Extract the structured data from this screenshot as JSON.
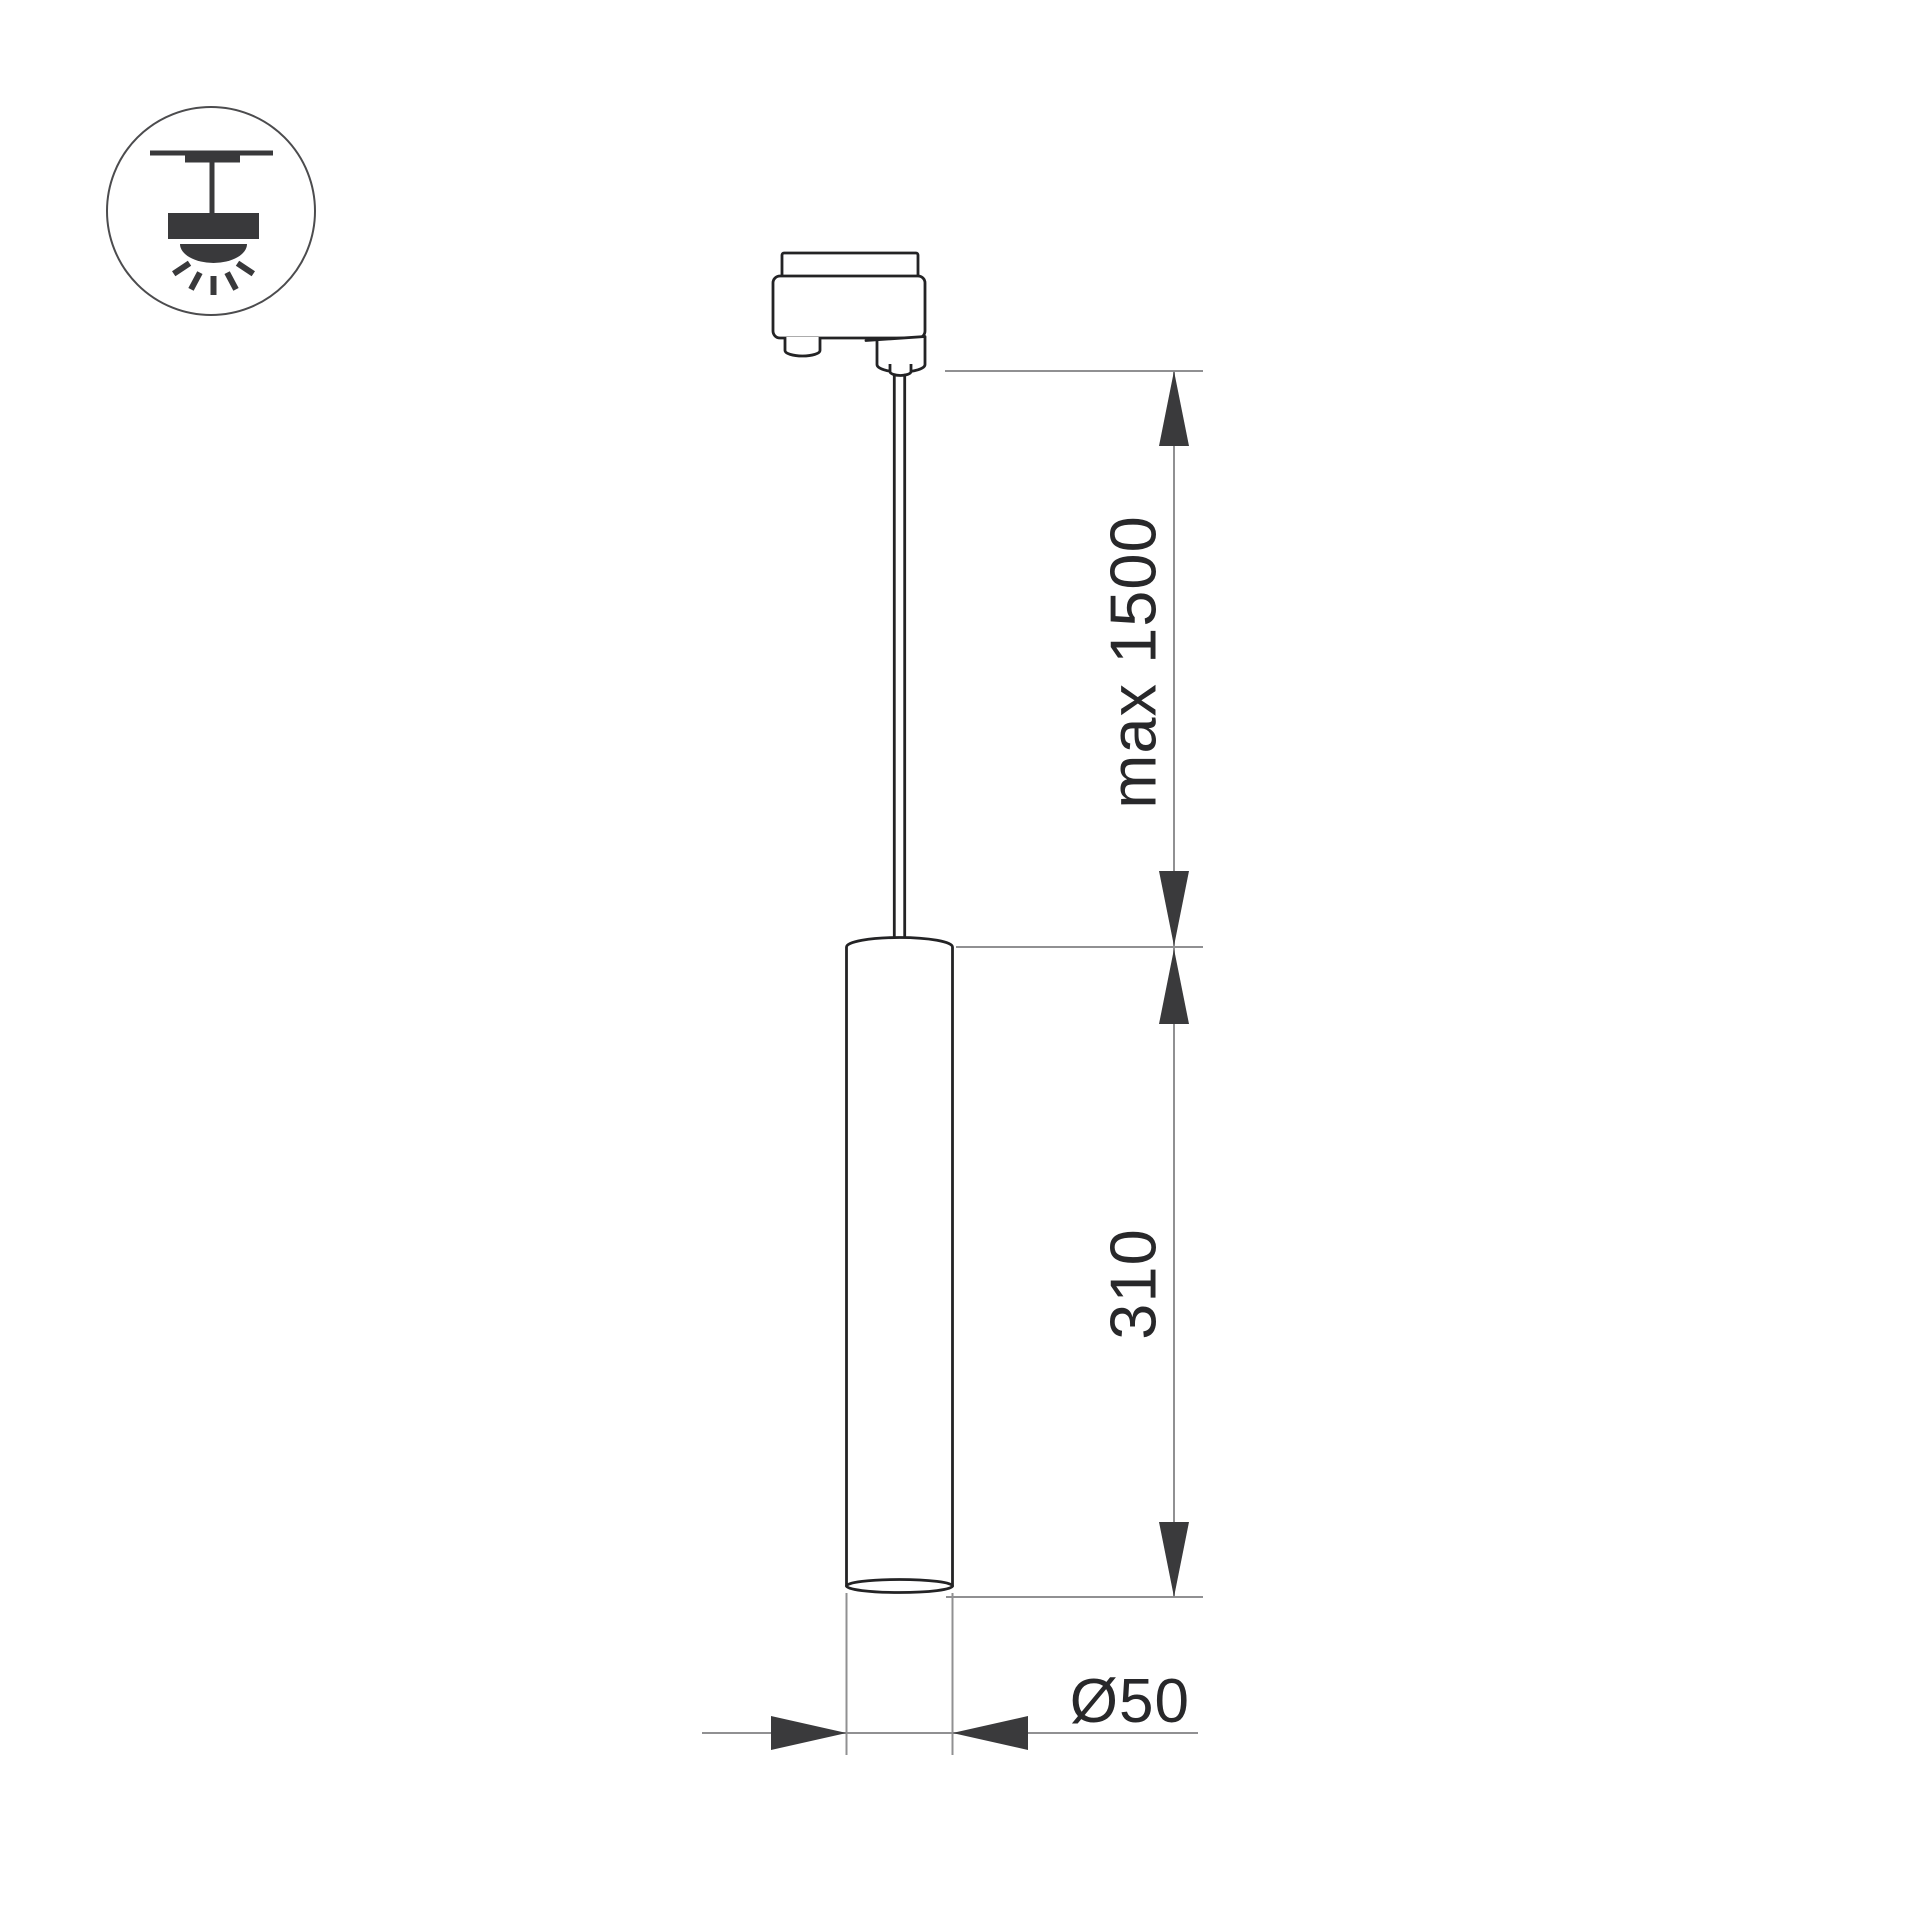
{
  "drawing": {
    "kind": "technical dimension drawing of a track-mounted pendant tube luminaire",
    "dimension_labels": {
      "suspension": "max 1500",
      "body_length": "310",
      "diameter": "Ø50"
    },
    "dimensions": [
      {
        "name": "suspension-length",
        "label": "max 1500",
        "orientation": "vertical"
      },
      {
        "name": "tube-length",
        "label": "310",
        "orientation": "vertical"
      },
      {
        "name": "tube-diameter",
        "label": "Ø50",
        "orientation": "horizontal"
      }
    ],
    "colors": {
      "background": "#ffffff",
      "outline": "#232325",
      "dimension_line": "#909092",
      "arrow_fill": "#3a3a3c",
      "label_text": "#28282a",
      "icon_fill": "#39393b"
    },
    "icon": {
      "name": "ceiling-pendant-mount-icon",
      "meaning": "pendant luminaire suspended from ceiling, light directed downward"
    }
  }
}
